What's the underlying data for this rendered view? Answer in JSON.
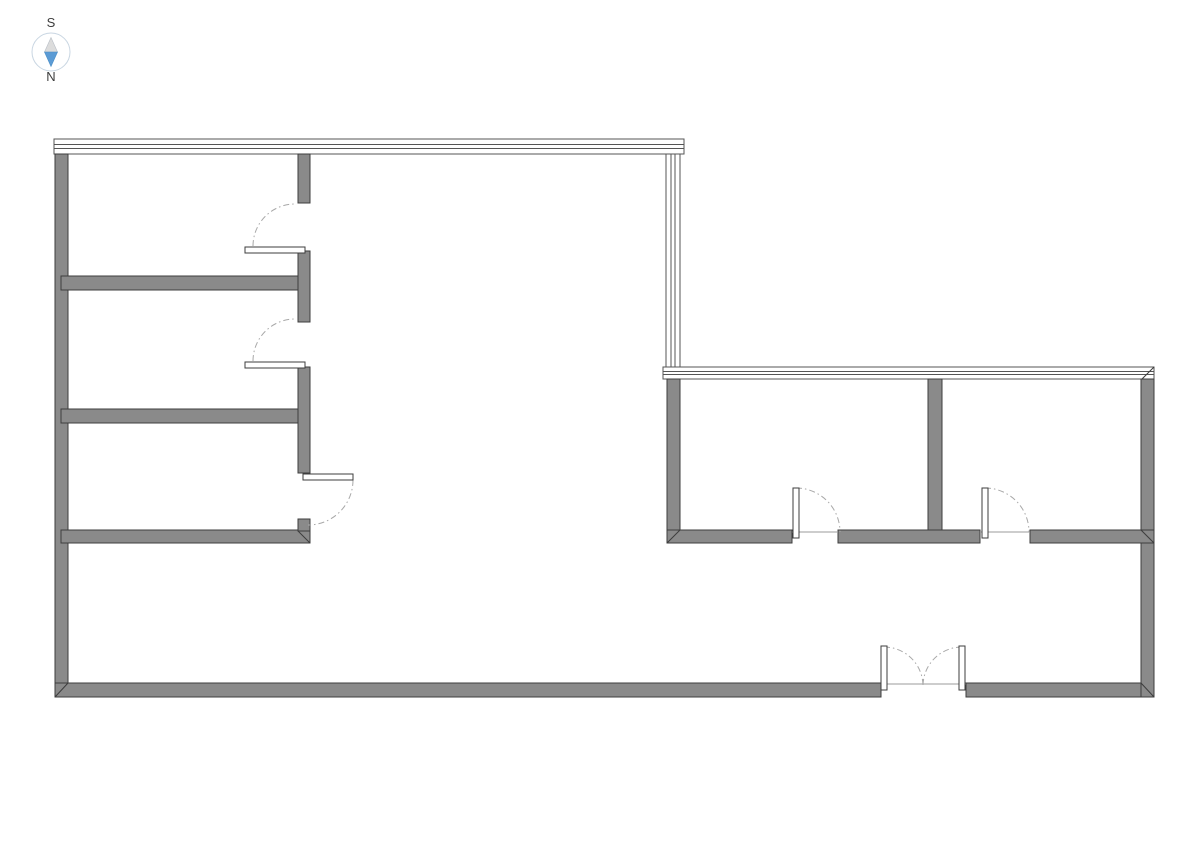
{
  "compass": {
    "top_label": "S",
    "bottom_label": "N",
    "label_color": "#3d3d3d",
    "ring_color": "#c9d6e2",
    "needle_upper_color": "#dcdcdc",
    "needle_lower_color": "#5b9bd5"
  },
  "colors": {
    "background": "#ffffff",
    "wall_fill": "#8a8a8a",
    "wall_outline": "#3d3d3d",
    "window_line": "#555555",
    "door_leaf_fill": "#ffffff",
    "door_leaf_outline": "#3d3d3d",
    "door_arc": "#a8a8a8",
    "threshold": "#9b9b9b"
  },
  "plan": {
    "canvas": {
      "width": 1191,
      "height": 842
    },
    "windows": [
      {
        "name": "window-band-north",
        "orient": "h",
        "x": 54,
        "y": 139,
        "len": 630,
        "th": 15
      },
      {
        "name": "window-band-mid-vertical",
        "orient": "v",
        "x": 666,
        "y": 154,
        "len": 213,
        "th": 14
      },
      {
        "name": "window-band-mid-horizontal",
        "orient": "h",
        "x": 663,
        "y": 367,
        "len": 491,
        "th": 12
      }
    ],
    "walls": [
      {
        "name": "exterior-wall-west",
        "x": 55,
        "y": 154,
        "w": 13,
        "h": 543
      },
      {
        "name": "exterior-wall-south-left",
        "x": 55,
        "y": 683,
        "w": 826,
        "h": 14
      },
      {
        "name": "exterior-wall-south-right",
        "x": 966,
        "y": 683,
        "w": 188,
        "h": 14
      },
      {
        "name": "exterior-wall-east",
        "x": 1141,
        "y": 379,
        "w": 13,
        "h": 318
      },
      {
        "name": "interior-wall-h1",
        "x": 61,
        "y": 276,
        "w": 249,
        "h": 14
      },
      {
        "name": "interior-wall-h2",
        "x": 61,
        "y": 409,
        "w": 249,
        "h": 14
      },
      {
        "name": "interior-wall-h3",
        "x": 61,
        "y": 530,
        "w": 249,
        "h": 13
      },
      {
        "name": "interior-wall-v-seg1",
        "x": 298,
        "y": 154,
        "w": 12,
        "h": 49
      },
      {
        "name": "interior-wall-v-seg2",
        "x": 298,
        "y": 251,
        "w": 12,
        "h": 71
      },
      {
        "name": "interior-wall-v-seg3",
        "x": 298,
        "y": 367,
        "w": 12,
        "h": 106
      },
      {
        "name": "interior-wall-v-return",
        "x": 298,
        "y": 519,
        "w": 12,
        "h": 12
      },
      {
        "name": "east-rooms-wall-west",
        "x": 667,
        "y": 379,
        "w": 13,
        "h": 164
      },
      {
        "name": "east-rooms-wall-divider",
        "x": 928,
        "y": 379,
        "w": 14,
        "h": 164
      },
      {
        "name": "east-rooms-wall-south-a",
        "x": 667,
        "y": 530,
        "w": 125,
        "h": 13
      },
      {
        "name": "east-rooms-wall-south-b",
        "x": 838,
        "y": 530,
        "w": 142,
        "h": 13
      },
      {
        "name": "east-rooms-wall-south-c",
        "x": 1030,
        "y": 530,
        "w": 124,
        "h": 13
      }
    ],
    "joints": [
      {
        "name": "miter-joint-southwest",
        "x1": 68,
        "y1": 683,
        "x2": 55,
        "y2": 697
      },
      {
        "name": "miter-joint-southeast",
        "x1": 1141,
        "y1": 683,
        "x2": 1154,
        "y2": 697
      },
      {
        "name": "miter-joint-east-rooms-left",
        "x1": 680,
        "y1": 530,
        "x2": 667,
        "y2": 543
      },
      {
        "name": "miter-joint-east-rooms-right",
        "x1": 1141,
        "y1": 530,
        "x2": 1154,
        "y2": 543
      },
      {
        "name": "miter-joint-wall-h3-end",
        "x1": 298,
        "y1": 531,
        "x2": 310,
        "y2": 543
      },
      {
        "name": "miter-joint-window-east-corner",
        "x1": 1154,
        "y1": 367,
        "x2": 1142,
        "y2": 379
      }
    ],
    "thresholds": [
      {
        "name": "threshold-east-room1",
        "x1": 792,
        "y1": 532,
        "x2": 838,
        "y2": 532
      },
      {
        "name": "threshold-east-room2",
        "x1": 980,
        "y1": 532,
        "x2": 1030,
        "y2": 532
      },
      {
        "name": "threshold-entry",
        "x1": 881,
        "y1": 684,
        "x2": 966,
        "y2": 684
      }
    ],
    "door_arcs": [
      {
        "name": "door-swing-west-room1",
        "d": "M 253 246 A 42 42 0 0 1 295 204"
      },
      {
        "name": "door-swing-west-room2",
        "d": "M 253 361 A 42 42 0 0 1 295 319"
      },
      {
        "name": "door-swing-west-room3",
        "d": "M 353 480 A 45 45 0 0 1 308 525"
      },
      {
        "name": "door-swing-east-room1",
        "d": "M 796 488 A 44 44 0 0 1 840 532"
      },
      {
        "name": "door-swing-east-room2",
        "d": "M 985 488 A 44 44 0 0 1 1029 532"
      },
      {
        "name": "door-swing-entry-left",
        "d": "M 884 647 A 39 39 0 0 1 923 686"
      },
      {
        "name": "door-swing-entry-right",
        "d": "M 962 647 A 39 39 0 0 0 923 686"
      }
    ],
    "door_leaves": [
      {
        "name": "door-leaf-west-room1",
        "x": 245,
        "y": 247,
        "w": 60,
        "h": 6
      },
      {
        "name": "door-leaf-west-room2",
        "x": 245,
        "y": 362,
        "w": 60,
        "h": 6
      },
      {
        "name": "door-leaf-west-room3",
        "x": 303,
        "y": 474,
        "w": 50,
        "h": 6
      },
      {
        "name": "door-leaf-east-room1",
        "x": 793,
        "y": 488,
        "w": 6,
        "h": 50
      },
      {
        "name": "door-leaf-east-room2",
        "x": 982,
        "y": 488,
        "w": 6,
        "h": 50
      },
      {
        "name": "door-leaf-entry-left",
        "x": 881,
        "y": 646,
        "w": 6,
        "h": 44
      },
      {
        "name": "door-leaf-entry-right",
        "x": 959,
        "y": 646,
        "w": 6,
        "h": 44
      }
    ]
  }
}
